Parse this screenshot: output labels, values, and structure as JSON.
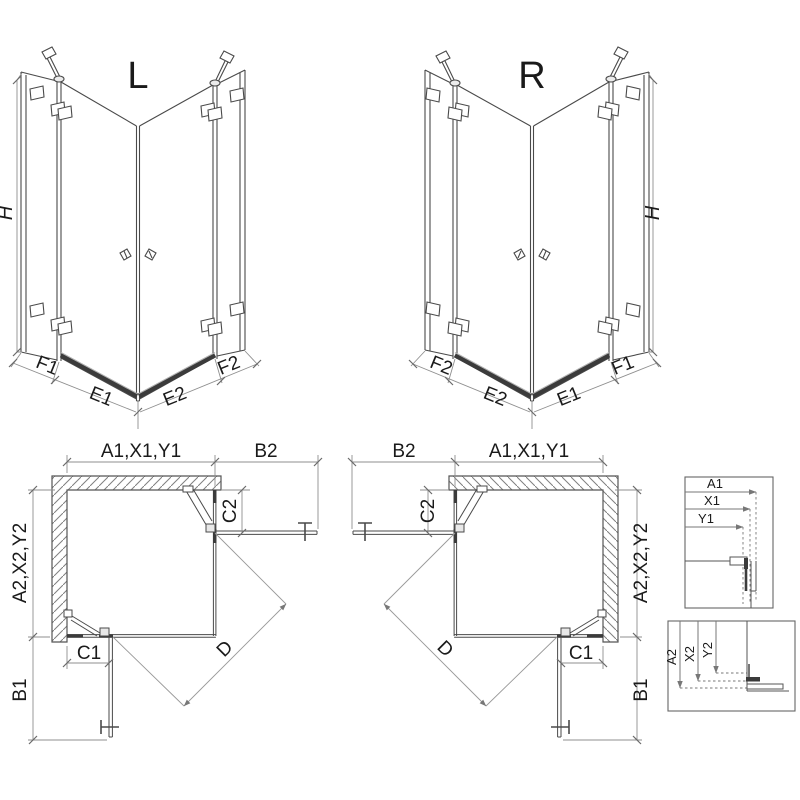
{
  "sheet": {
    "views": {
      "iso_left": {
        "variant_label": "L"
      },
      "iso_right": {
        "variant_label": "R"
      }
    },
    "dimension_labels": {
      "height": "H",
      "f1": "F1",
      "e1": "E1",
      "e2": "E2",
      "f2": "F2",
      "a1x1y1": "A1,X1,Y1",
      "b2": "B2",
      "a2x2y2": "A2,X2,Y2",
      "c1": "C1",
      "c2": "C2",
      "b1": "B1",
      "d": "D"
    },
    "detail_top": {
      "a1": "A1",
      "x1": "X1",
      "y1": "Y1"
    },
    "detail_bottom": {
      "a2": "A2",
      "x2": "X2",
      "y2": "Y2"
    },
    "colors": {
      "line": "#4a4a4a",
      "dimension_line": "#8f8f8f",
      "dark_profile": "#3b3b3b",
      "text": "#1a1a1a",
      "background": "#ffffff"
    }
  }
}
